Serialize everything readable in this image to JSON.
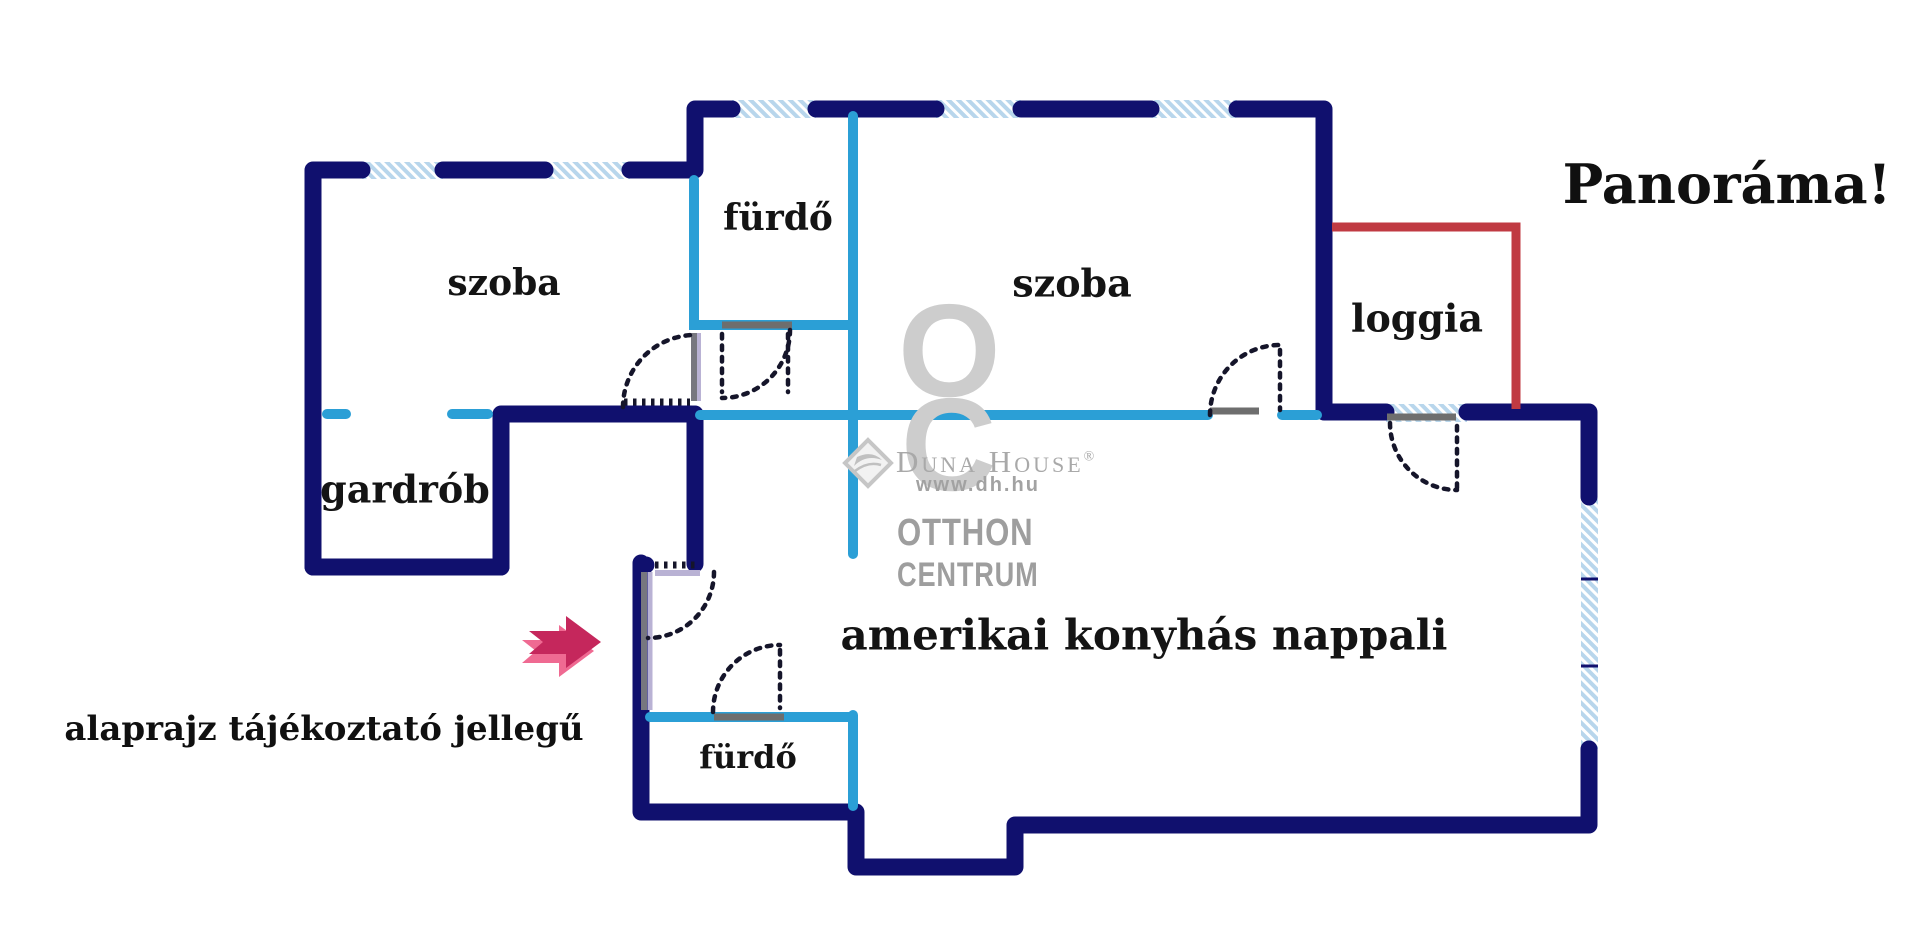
{
  "plan": {
    "rooms": {
      "bedroom_left": "szoba",
      "bathroom_top": "fürdő",
      "bedroom_main": "szoba",
      "loggia": "loggia",
      "wardrobe": "gardrób",
      "bathroom_bottom": "fürdő",
      "living_room": "amerikai konyhás nappali"
    },
    "annotations": {
      "panorama": "Panoráma!",
      "disclaimer": "alaprajz tájékoztató jellegű"
    },
    "colors": {
      "wall": "#10106e",
      "partition": "#2b9fd6",
      "loggia_outline": "#c03a42",
      "window_fill": "#b8d6ec",
      "window_stripe": "#ffffff",
      "door_bar": "#6e6e6e",
      "door_leaf_gray": "#77777f",
      "door_leaf_lavender": "#b9b2d4",
      "door_arc": "#15152a",
      "arrow_dark": "#c5275c",
      "arrow_light": "#ef6a92",
      "watermark_gray": "#b3b3b3"
    }
  },
  "watermark": {
    "logo_letter_o": "O",
    "logo_letter_c": "C",
    "brand": "Duna House",
    "registered": "®",
    "url": "www.dh.hu",
    "line1": "OTTHON",
    "line2": "CENTRUM"
  }
}
